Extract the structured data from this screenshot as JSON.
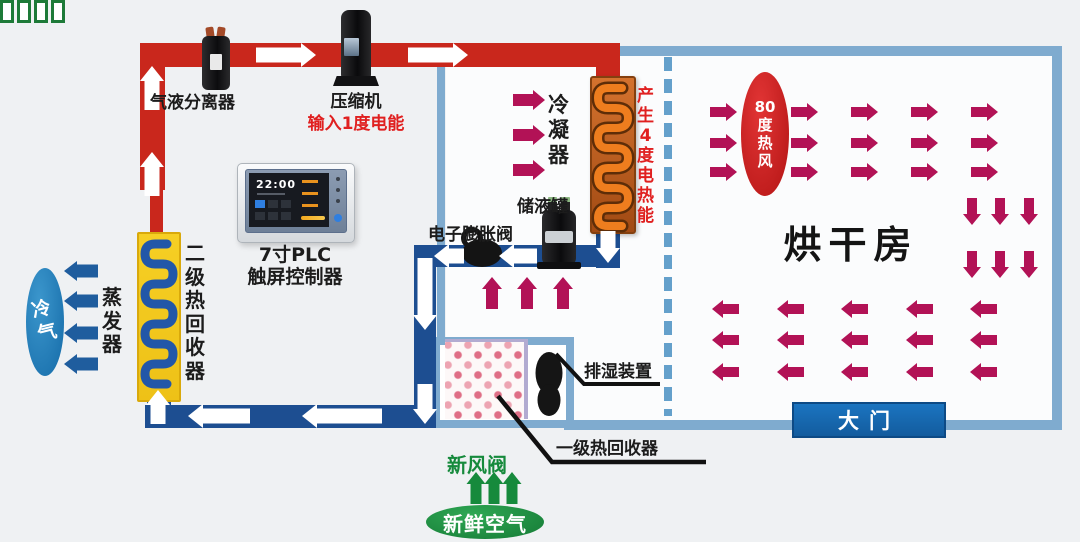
{
  "title": "热泵烘干系统原理图",
  "labels": {
    "gas_liquid_separator": "气液分离器",
    "compressor": "压缩机",
    "compressor_energy": "输入1度电能",
    "plc_line1": "7寸PLC",
    "plc_line2": "触屏控制器",
    "plc_time": "22:00",
    "condenser": "冷凝器",
    "condenser_energy": "产生4度电热能",
    "liquid_tank": "储液罐",
    "expansion_valve": "电子膨胀阀",
    "evaporator": "蒸发器",
    "secondary_heat_recovery": "二级热回收器",
    "cold_air": "冷气",
    "drying_room": "烘干房",
    "hot_air": "80度热风",
    "hot_air_chunks": [
      "80",
      "度",
      "热",
      "风"
    ],
    "door": "大门",
    "dehumidifier": "排湿装置",
    "primary_heat_recovery": "一级热回收器",
    "fresh_air_valve": "新风阀",
    "fresh_air": "新鲜空气"
  },
  "colors": {
    "hot_pipe": "#c9271c",
    "cold_pipe": "#1d4e91",
    "room_wall": "#7fabcf",
    "dashed_partition": "#64a0cb",
    "airflow_arrow": "#b21256",
    "cold_air_arrow": "#1f5d9e",
    "fresh_air_arrow": "#168a3c",
    "hot_air_oval": "#b31414",
    "cold_air_oval": "#156ba8",
    "fresh_air_oval": "#157a35",
    "door_fill": "#1b74c0",
    "condenser_box": "#a14a13",
    "condenser_coil": "#ee7d1e",
    "evaporator_box": "#f2c71e",
    "evaporator_coil": "#2257a8",
    "energy_text_red": "#e02020"
  },
  "arrows": {
    "hot_gas_pipe_flow": {
      "color": "#ffffff",
      "shaft": 7.5,
      "head": 12,
      "headlen": 15,
      "items": [
        {
          "tip": [
            152,
            66
          ],
          "dir": "up",
          "len": 44
        },
        {
          "tip": [
            152,
            152
          ],
          "dir": "up",
          "len": 44
        },
        {
          "tip": [
            316,
            55
          ],
          "dir": "right",
          "len": 60
        },
        {
          "tip": [
            468,
            55
          ],
          "dir": "right",
          "len": 60
        },
        {
          "tip": [
            608,
            263
          ],
          "dir": "down",
          "len": 32
        },
        {
          "tip": [
            499,
            256
          ],
          "dir": "left",
          "len": 38
        },
        {
          "tip": [
            434,
            256
          ],
          "dir": "left",
          "len": 30
        },
        {
          "tip": [
            425,
            330
          ],
          "dir": "down",
          "len": 72
        },
        {
          "tip": [
            425,
            424
          ],
          "dir": "down",
          "len": 40
        },
        {
          "tip": [
            188,
            416
          ],
          "dir": "left",
          "len": 62
        },
        {
          "tip": [
            302,
            416
          ],
          "dir": "left",
          "len": 80
        },
        {
          "tip": [
            158,
            390
          ],
          "dir": "up",
          "len": 34
        }
      ]
    },
    "hot_air_supply": {
      "color": "#b21256",
      "shaft": 5,
      "head": 9,
      "headlen": 11,
      "grid": {
        "dir": "right",
        "len": 27,
        "xs": [
          737,
          818,
          878,
          938,
          998
        ],
        "ys": [
          112,
          143,
          172
        ]
      }
    },
    "hot_air_descend": {
      "color": "#b21256",
      "shaft": 5,
      "head": 9,
      "headlen": 11,
      "grid": {
        "dir": "down",
        "len": 27,
        "xs": [
          972,
          1000,
          1029
        ],
        "ys": [
          225,
          278
        ]
      }
    },
    "hot_air_return": {
      "color": "#b21256",
      "shaft": 5,
      "head": 9,
      "headlen": 11,
      "grid": {
        "dir": "left",
        "len": 27,
        "xs": [
          712,
          777,
          841,
          906,
          970
        ],
        "ys": [
          309,
          340,
          372
        ]
      }
    },
    "condenser_airflow": {
      "color": "#b21256",
      "shaft": 6,
      "head": 10,
      "headlen": 12,
      "items": [
        {
          "tip": [
            545,
            100
          ],
          "dir": "right",
          "len": 32
        },
        {
          "tip": [
            545,
            135
          ],
          "dir": "right",
          "len": 32
        },
        {
          "tip": [
            545,
            170
          ],
          "dir": "right",
          "len": 32
        }
      ]
    },
    "recovered_air_up": {
      "color": "#b21256",
      "shaft": 6,
      "head": 10,
      "headlen": 12,
      "items": [
        {
          "tip": [
            492,
            277
          ],
          "dir": "up",
          "len": 32
        },
        {
          "tip": [
            527,
            277
          ],
          "dir": "up",
          "len": 32
        },
        {
          "tip": [
            563,
            277
          ],
          "dir": "up",
          "len": 32
        }
      ]
    },
    "cold_air_out": {
      "color": "#1f5d9e",
      "shaft": 6.5,
      "head": 10,
      "headlen": 13,
      "items": [
        {
          "tip": [
            64,
            271
          ],
          "dir": "left",
          "len": 34
        },
        {
          "tip": [
            64,
            301
          ],
          "dir": "left",
          "len": 34
        },
        {
          "tip": [
            64,
            333
          ],
          "dir": "left",
          "len": 34
        },
        {
          "tip": [
            64,
            364
          ],
          "dir": "left",
          "len": 34
        }
      ]
    },
    "fresh_air_in": {
      "color": "#168a3c",
      "shaft": 5.5,
      "head": 9.5,
      "headlen": 12,
      "items": [
        {
          "tip": [
            476,
            472
          ],
          "dir": "up",
          "len": 32
        },
        {
          "tip": [
            494,
            472
          ],
          "dir": "up",
          "len": 32
        },
        {
          "tip": [
            512,
            472
          ],
          "dir": "up",
          "len": 32
        }
      ]
    }
  }
}
